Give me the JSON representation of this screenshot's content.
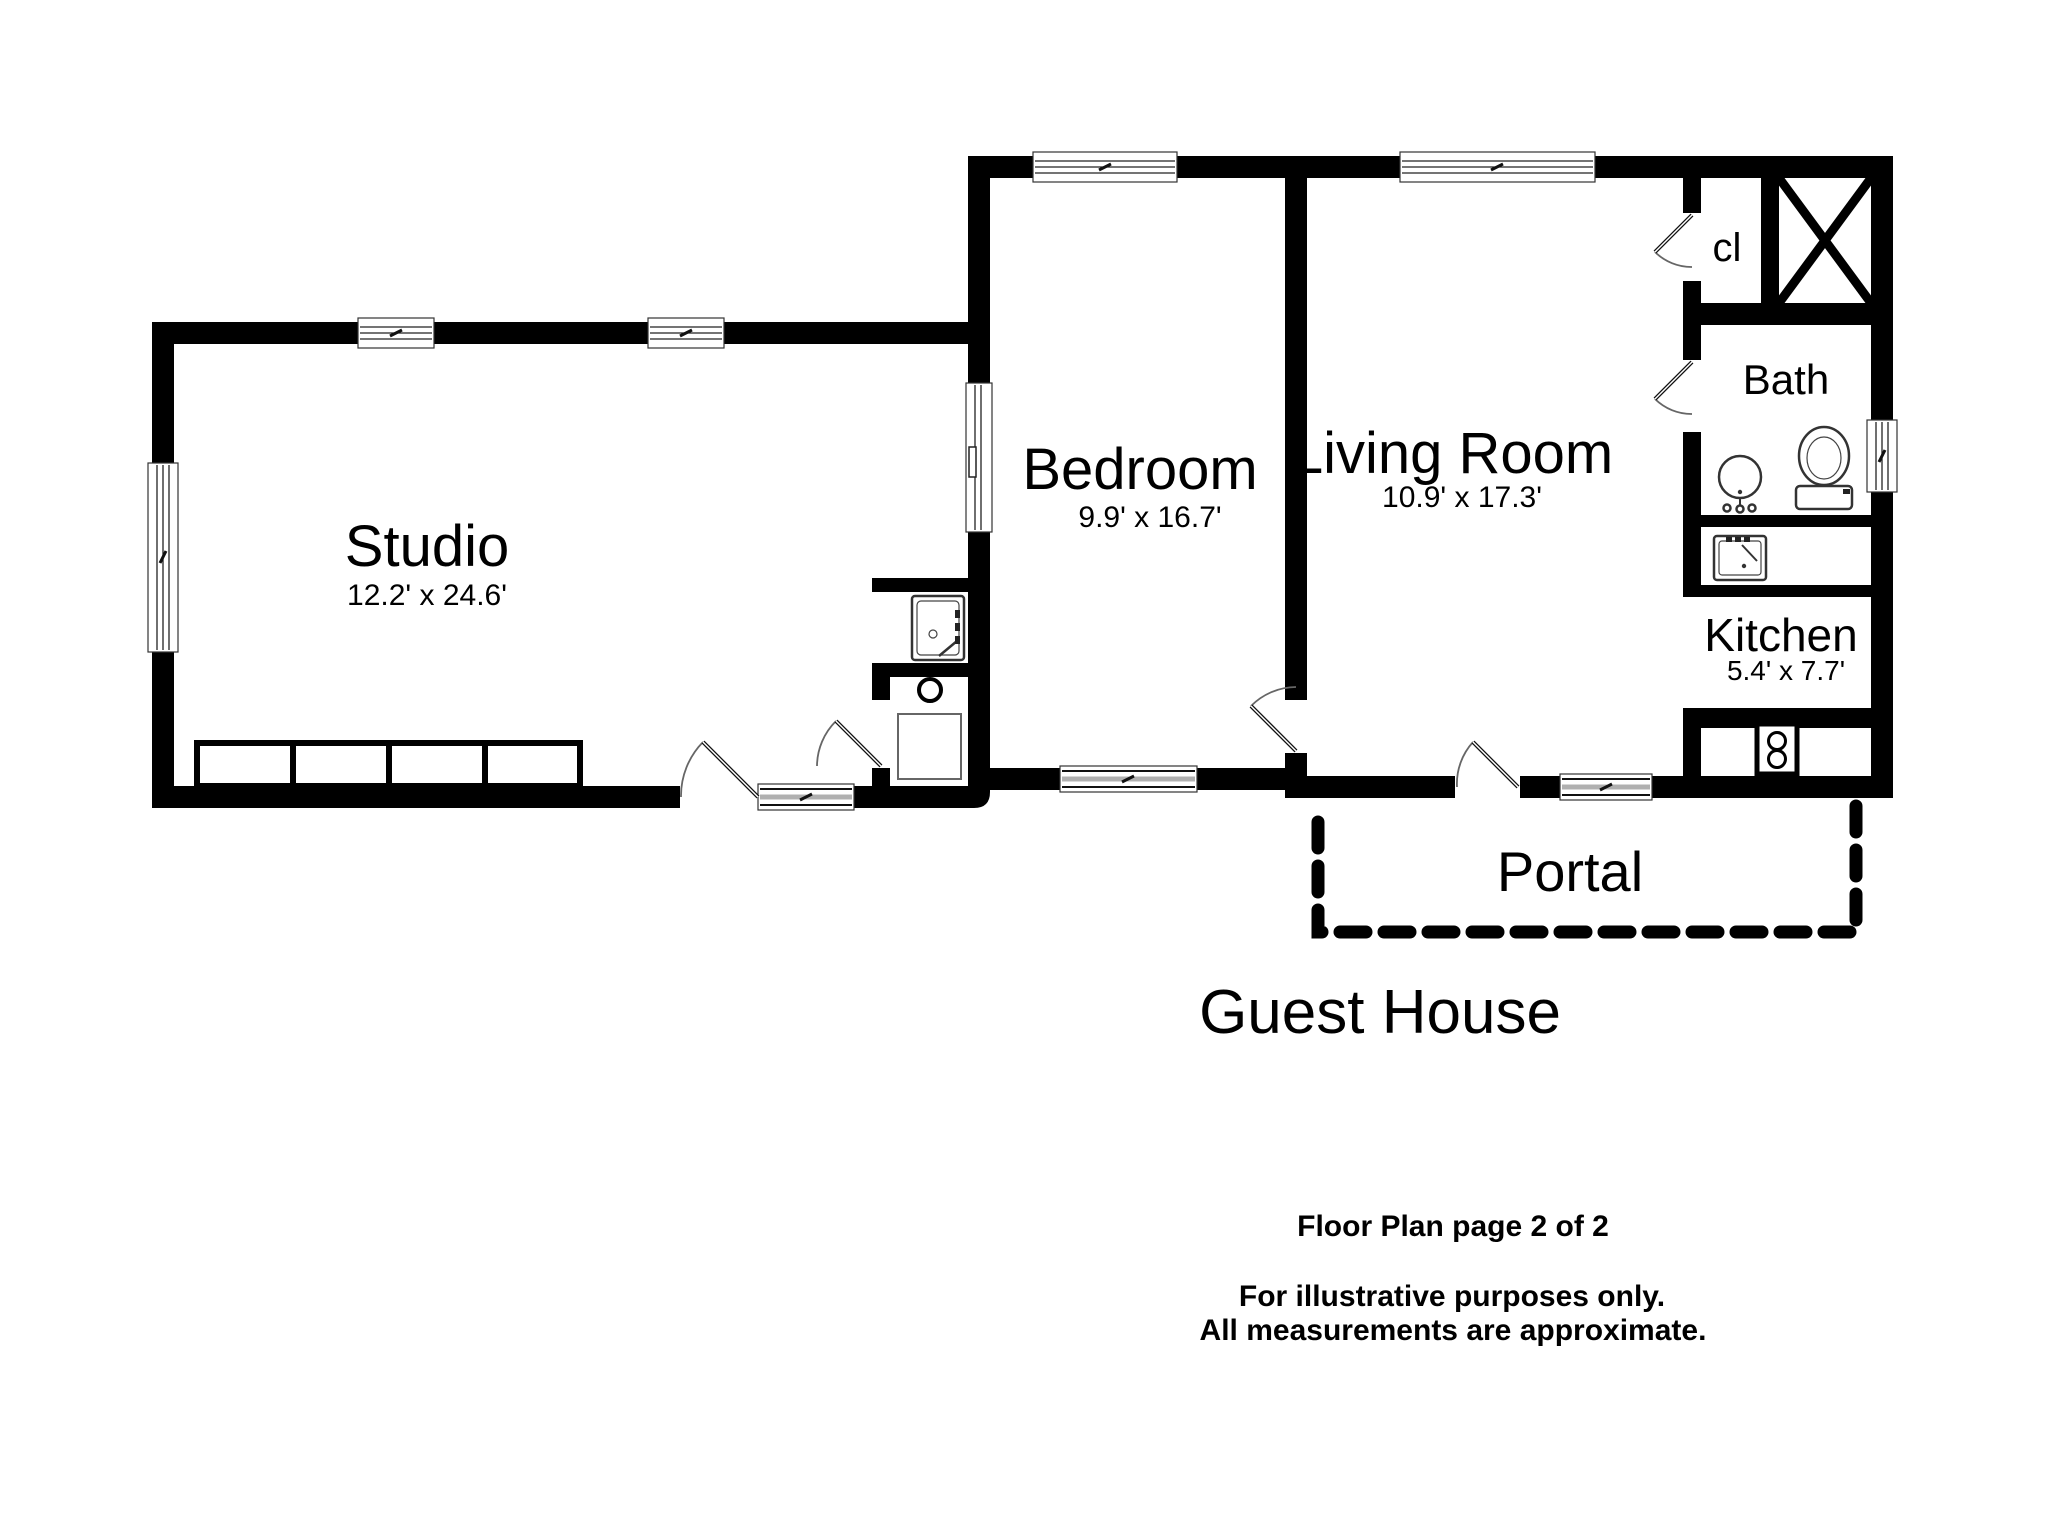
{
  "plan": {
    "title": "Guest House",
    "rooms": {
      "studio": {
        "name": "Studio",
        "dims": "12.2' x 24.6'"
      },
      "bedroom": {
        "name": "Bedroom",
        "dims": "9.9' x 16.7'"
      },
      "living_room": {
        "name": "Living Room",
        "dims": "10.9' x 17.3'"
      },
      "kitchen": {
        "name": "Kitchen",
        "dims": "5.4' x 7.7'"
      },
      "bath": {
        "name": "Bath"
      },
      "closet": {
        "name": "cl"
      },
      "portal": {
        "name": "Portal"
      }
    },
    "colors": {
      "wall": "#000000",
      "background": "#ffffff",
      "slider_glass": "#b0b0b0"
    }
  },
  "footer": {
    "page_label": "Floor Plan page 2 of 2",
    "disclaimer_line1": "For illustrative purposes only.",
    "disclaimer_line2": "All measurements are approximate."
  }
}
